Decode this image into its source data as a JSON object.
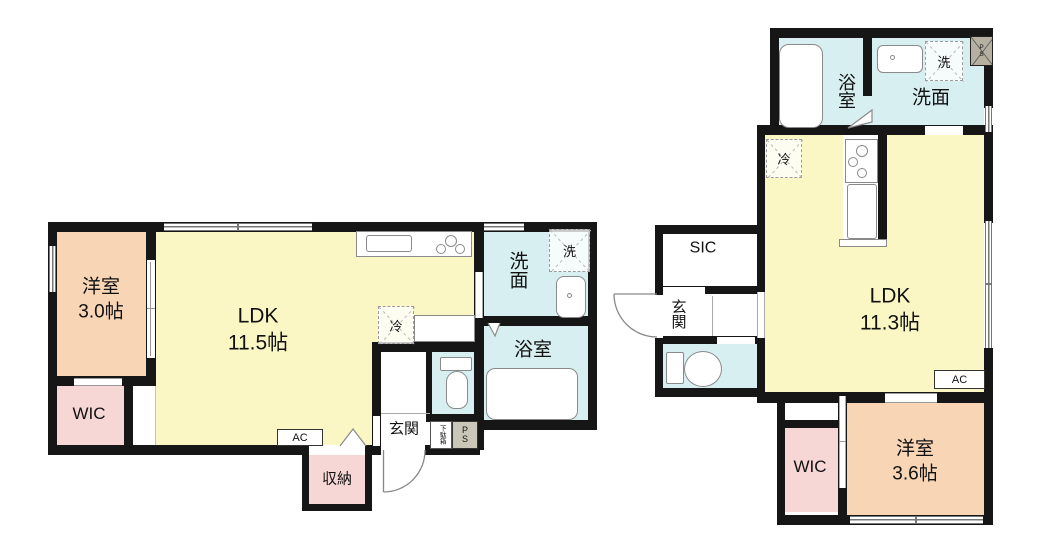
{
  "colors": {
    "wall": "#161616",
    "ldk_fill": "#faf7c4",
    "western_room_fill": "#f7d5b5",
    "closet_fill": "#f7d6d6",
    "wet_area_fill": "#d7eff1",
    "pipe_space_fill": "#cbc7b8"
  },
  "left_plan": {
    "western_room_label": "洋室\n3.0帖",
    "wic_label": "WIC",
    "ldk_label": "LDK\n11.5帖",
    "washroom_label": "洗面",
    "washer_label": "洗",
    "fridge_label": "冷",
    "bath_label": "浴室",
    "entrance_label": "玄関",
    "shoe_cabinet_label": "下駄箱",
    "pipe_space_label": "P\nS",
    "ac_label": "AC",
    "storage_label": "収納"
  },
  "right_plan": {
    "bath_label": "浴室",
    "washroom_label": "洗面",
    "washer_label": "洗",
    "pipe_space_label": "P\nS",
    "fridge_label": "冷",
    "sic_label": "SIC",
    "entrance_label": "玄関",
    "ldk_label": "LDK\n11.3帖",
    "ac_label": "AC",
    "wic_label": "WIC",
    "western_room_label": "洋室\n3.6帖"
  }
}
